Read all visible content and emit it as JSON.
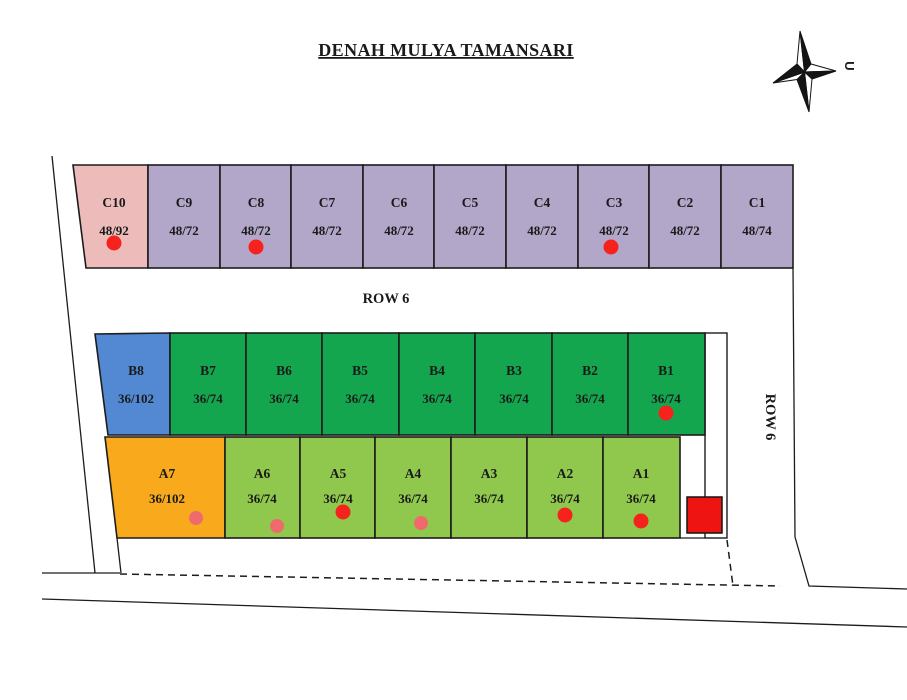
{
  "title": "DENAH MULYA TAMANSARI",
  "compass": {
    "letter": "U"
  },
  "road_labels": {
    "row6_horizontal": "ROW 6",
    "row6_vertical": "ROW 6"
  },
  "plots": {
    "c_row": [
      {
        "id": "C10",
        "size": "48/92"
      },
      {
        "id": "C9",
        "size": "48/72"
      },
      {
        "id": "C8",
        "size": "48/72"
      },
      {
        "id": "C7",
        "size": "48/72"
      },
      {
        "id": "C6",
        "size": "48/72"
      },
      {
        "id": "C5",
        "size": "48/72"
      },
      {
        "id": "C4",
        "size": "48/72"
      },
      {
        "id": "C3",
        "size": "48/72"
      },
      {
        "id": "C2",
        "size": "48/72"
      },
      {
        "id": "C1",
        "size": "48/74"
      }
    ],
    "b_row": [
      {
        "id": "B8",
        "size": "36/102"
      },
      {
        "id": "B7",
        "size": "36/74"
      },
      {
        "id": "B6",
        "size": "36/74"
      },
      {
        "id": "B5",
        "size": "36/74"
      },
      {
        "id": "B4",
        "size": "36/74"
      },
      {
        "id": "B3",
        "size": "36/74"
      },
      {
        "id": "B2",
        "size": "36/74"
      },
      {
        "id": "B1",
        "size": "36/74"
      }
    ],
    "a_row": [
      {
        "id": "A7",
        "size": "36/102"
      },
      {
        "id": "A6",
        "size": "36/74"
      },
      {
        "id": "A5",
        "size": "36/74"
      },
      {
        "id": "A4",
        "size": "36/74"
      },
      {
        "id": "A3",
        "size": "36/74"
      },
      {
        "id": "A2",
        "size": "36/74"
      },
      {
        "id": "A1",
        "size": "36/74"
      }
    ]
  },
  "markers": [
    {
      "plot": "C10",
      "x": 114,
      "y": 243,
      "color": "red"
    },
    {
      "plot": "C8",
      "x": 256,
      "y": 247,
      "color": "red"
    },
    {
      "plot": "C3",
      "x": 611,
      "y": 247,
      "color": "red"
    },
    {
      "plot": "B1",
      "x": 666,
      "y": 413,
      "color": "red"
    },
    {
      "plot": "A7",
      "x": 196,
      "y": 518,
      "color": "salmon"
    },
    {
      "plot": "A6",
      "x": 277,
      "y": 526,
      "color": "salmon"
    },
    {
      "plot": "A5",
      "x": 343,
      "y": 512,
      "color": "red"
    },
    {
      "plot": "A4",
      "x": 421,
      "y": 523,
      "color": "salmon"
    },
    {
      "plot": "A2",
      "x": 565,
      "y": 515,
      "color": "red"
    },
    {
      "plot": "A1",
      "x": 641,
      "y": 521,
      "color": "red"
    }
  ],
  "colors": {
    "title_blue": "#2a6ba8",
    "lavender": "#b3a7c9",
    "pink": "#edbcba",
    "blue": "#5389d2",
    "green": "#13a64e",
    "light_green": "#90c84e",
    "orange": "#f8a91c",
    "red": "#f5231c",
    "salmon": "#ef6a6d",
    "red_square": "#ee1411",
    "ink": "#1c1c1c"
  }
}
